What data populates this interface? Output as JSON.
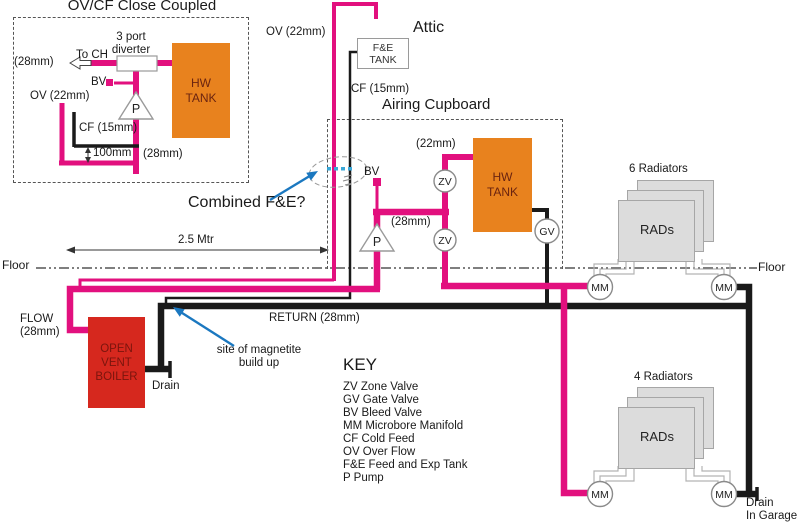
{
  "colors": {
    "flow_pink": "#E2107E",
    "return_black": "#1A1A1A",
    "tank_orange": "#E8821E",
    "boiler_red": "#D6281E",
    "arrow_blue": "#1B78C0",
    "radiator_gray": "#DCDCDC"
  },
  "inset": {
    "title": "OV/CF Close Coupled",
    "to_ch": "To CH",
    "size_left": "(28mm)",
    "diverter1": "3 port",
    "diverter2": "diverter",
    "bv": "BV",
    "ov": "OV (22mm)",
    "cf": "CF (15mm)",
    "dim100": "100mm",
    "size_right": "(28mm)",
    "pump": "P",
    "tank1": "HW",
    "tank2": "TANK"
  },
  "attic": {
    "label": "Attic",
    "ov": "OV (22mm)",
    "fe1": "F&E",
    "fe2": "TANK",
    "cf": "CF (15mm)"
  },
  "cupboard": {
    "label": "Airing Cupboard",
    "size22": "(22mm)",
    "size28": "(28mm)",
    "bv": "BV",
    "pump": "P",
    "zv": "ZV",
    "gv": "GV",
    "tank1": "HW",
    "tank2": "TANK"
  },
  "notes": {
    "combined": "Combined F&E?",
    "dim25": "2.5 Mtr",
    "mag1": "site of magnetite",
    "mag2": "build up"
  },
  "floor": {
    "left": "Floor",
    "right": "Floor"
  },
  "lower": {
    "flow1": "FLOW",
    "flow2": "(28mm)",
    "boiler1": "OPEN",
    "boiler2": "VENT",
    "boiler3": "BOILER",
    "return_label": "RETURN (28mm)",
    "drain": "Drain"
  },
  "rads6": {
    "title": "6 Radiators",
    "label": "RADs",
    "mm": "MM"
  },
  "rads4": {
    "title": "4 Radiators",
    "label": "RADs",
    "mm": "MM",
    "drain1": "Drain",
    "drain2": "In Garage"
  },
  "key": {
    "title": "KEY",
    "items": [
      "ZV Zone Valve",
      "GV Gate Valve",
      "BV Bleed Valve",
      "MM Microbore Manifold",
      "CF Cold Feed",
      "OV Over Flow",
      "F&E Feed and Exp Tank",
      "P Pump"
    ]
  }
}
